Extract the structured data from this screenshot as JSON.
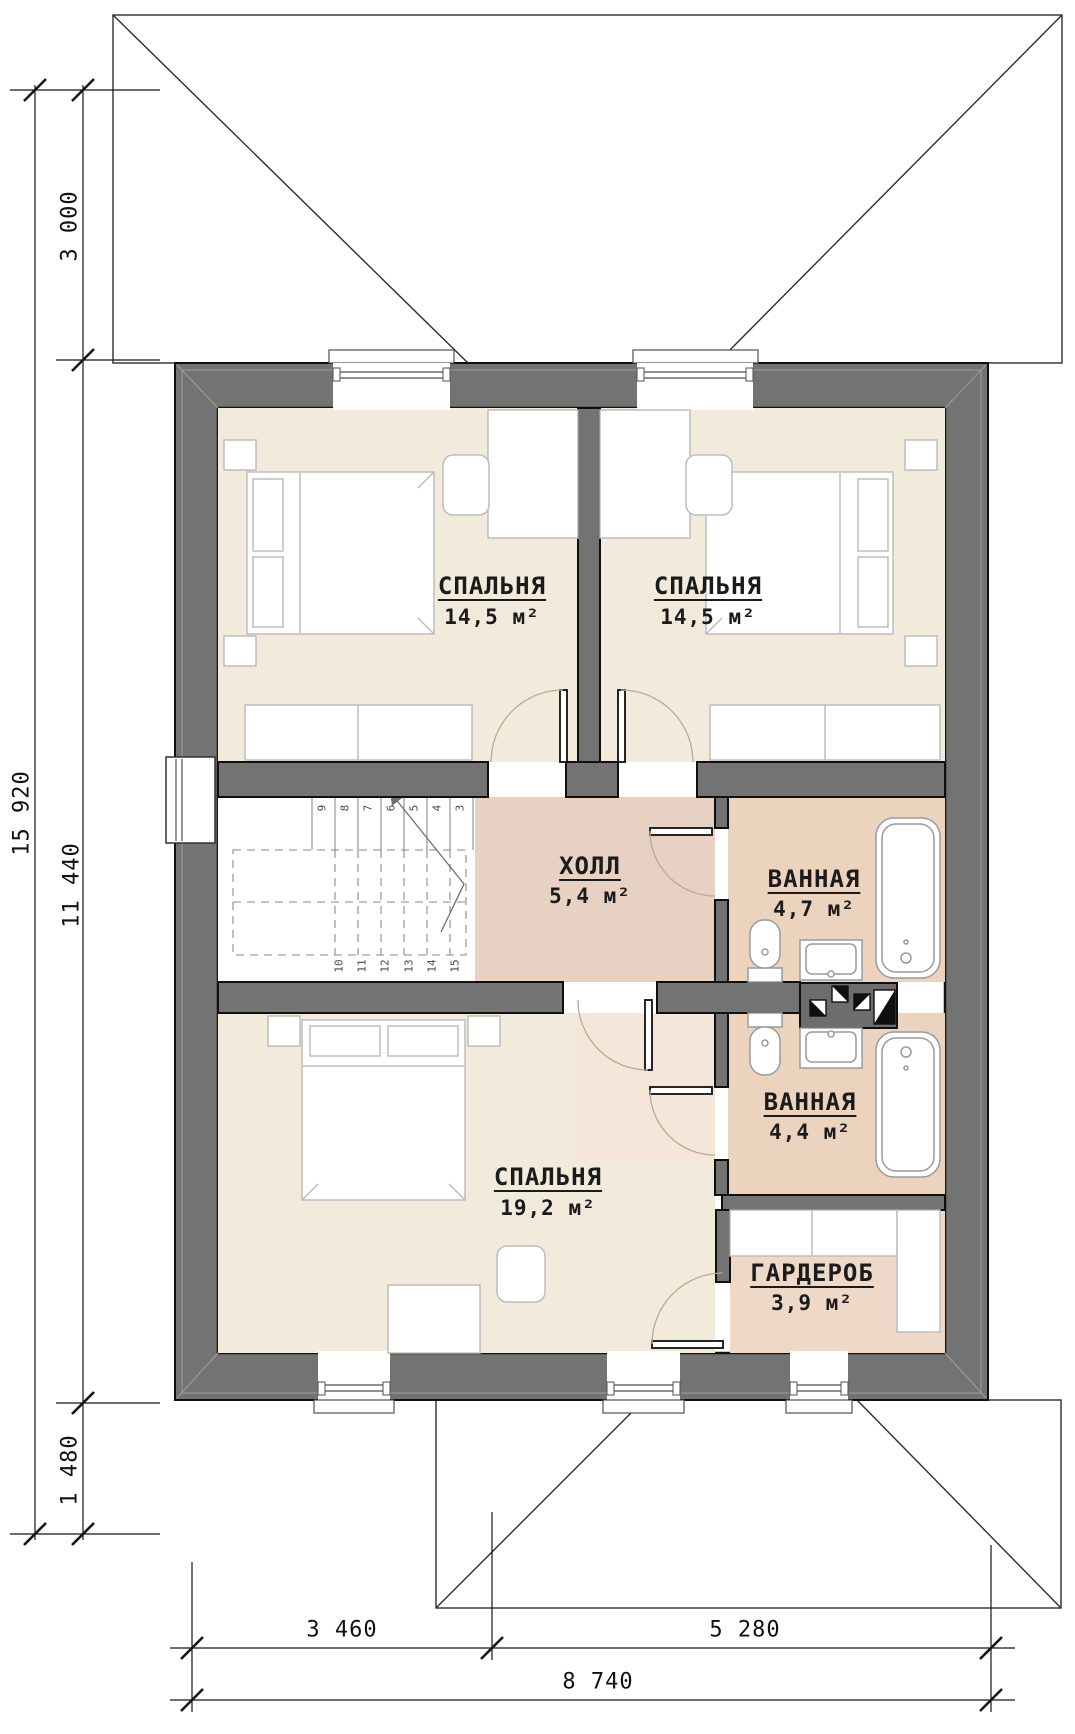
{
  "plan": {
    "title": "floor-plan-second-storey",
    "rooms": [
      {
        "id": "bedroom-1",
        "name": "СПАЛЬНЯ",
        "area": "14,5 м²"
      },
      {
        "id": "bedroom-2",
        "name": "СПАЛЬНЯ",
        "area": "14,5 м²"
      },
      {
        "id": "hall",
        "name": "ХОЛЛ",
        "area": "5,4 м²"
      },
      {
        "id": "bathroom-1",
        "name": "ВАННАЯ",
        "area": "4,7 м²"
      },
      {
        "id": "bathroom-2",
        "name": "ВАННАЯ",
        "area": "4,4 м²"
      },
      {
        "id": "bedroom-3",
        "name": "СПАЛЬНЯ",
        "area": "19,2 м²"
      },
      {
        "id": "wardrobe",
        "name": "ГАРДЕРОБ",
        "area": "3,9 м²"
      }
    ],
    "dimensions": {
      "left": [
        "3 000",
        "15 920",
        "11 440",
        "1 480"
      ],
      "bottom": [
        "3 460",
        "5 280",
        "8 740"
      ]
    },
    "stairs": {
      "upper_steps": [
        "9",
        "8",
        "7",
        "6",
        "5",
        "4",
        "3"
      ],
      "lower_steps": [
        "10",
        "11",
        "12",
        "13",
        "14",
        "15"
      ]
    },
    "colors": {
      "wall": "#737373",
      "bedroom_fill": "#f2ebdc",
      "hall_fill": "#e7d1c2",
      "bath_fill": "#ecd3be",
      "wardrobe_fill": "#eed8c8",
      "swing_zone_fill": "#f4e6d8"
    }
  }
}
